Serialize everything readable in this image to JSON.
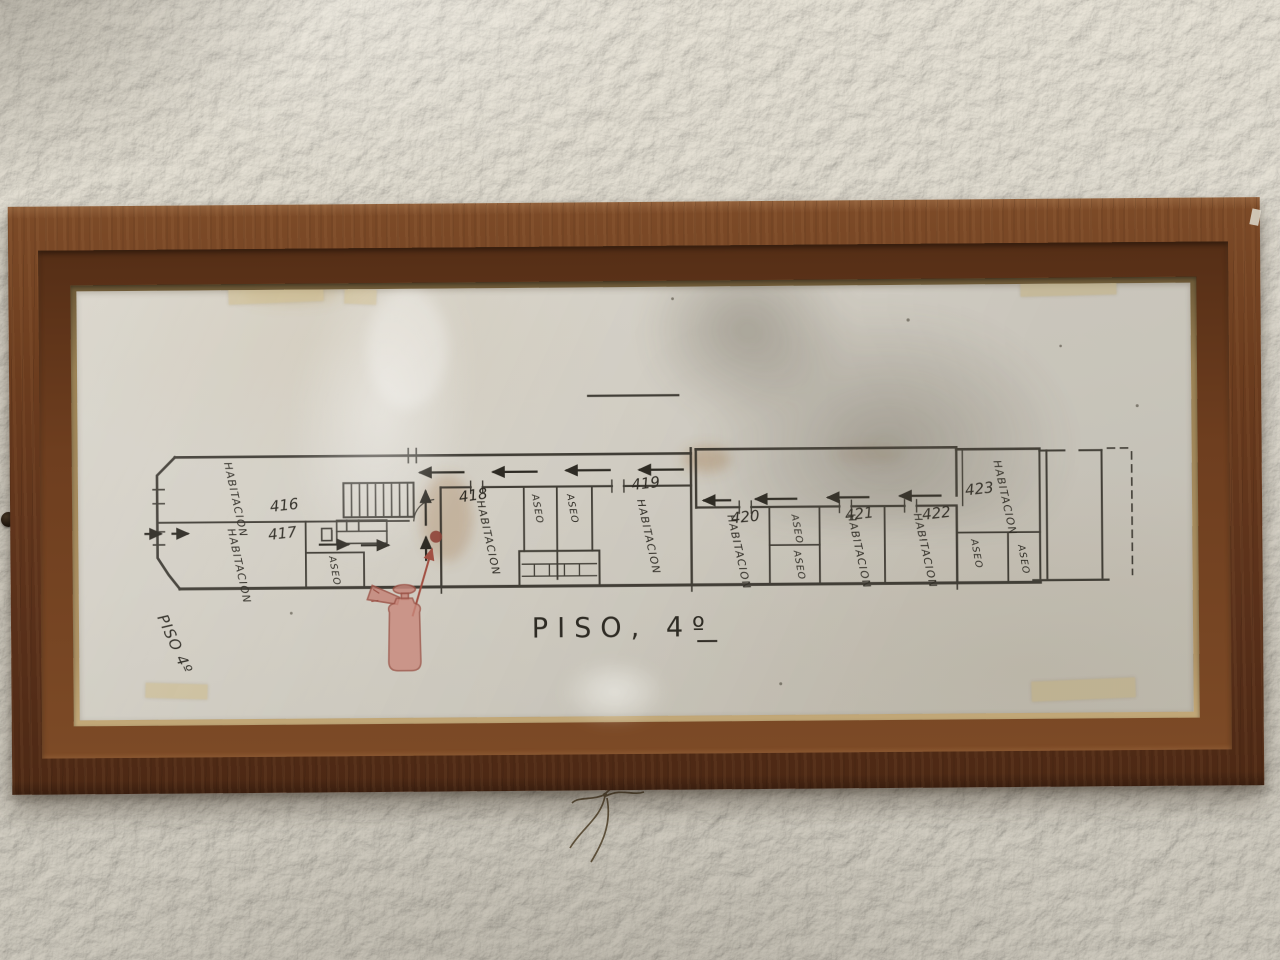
{
  "colors": {
    "wall": "#d9d5c9",
    "frame_wood": "#6b3c1e",
    "frame_lip": "#b09466",
    "paper": "#d4d0c6",
    "ink": "#2d2a23",
    "red": "#a14f42",
    "tape": "#cab684"
  },
  "plan": {
    "title": "PISO, 4º",
    "side_label": "PISO 4º",
    "room_label": "HABITACION",
    "aseo_label": "ASEO",
    "rooms": [
      {
        "number": "416"
      },
      {
        "number": "417"
      },
      {
        "number": "418"
      },
      {
        "number": "419"
      },
      {
        "number": "420"
      },
      {
        "number": "421"
      },
      {
        "number": "422"
      },
      {
        "number": "423"
      }
    ]
  }
}
